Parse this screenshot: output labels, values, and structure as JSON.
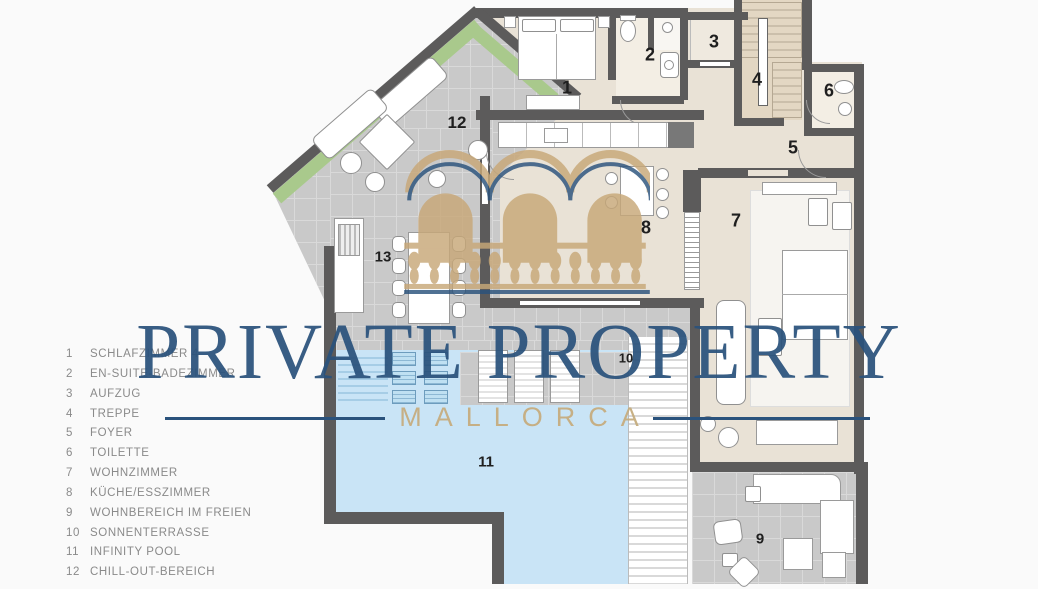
{
  "watermark": {
    "title": "PRIVATE PROPERTY",
    "subtitle": "MALLORCA"
  },
  "legend": {
    "items": [
      {
        "num": "1",
        "label": "SCHLAFZIMMER 4"
      },
      {
        "num": "2",
        "label": "EN-SUITE-BADEZIMMER"
      },
      {
        "num": "3",
        "label": "AUFZUG"
      },
      {
        "num": "4",
        "label": "TREPPE"
      },
      {
        "num": "5",
        "label": "FOYER"
      },
      {
        "num": "6",
        "label": "TOILETTE"
      },
      {
        "num": "7",
        "label": "WOHNZIMMER"
      },
      {
        "num": "8",
        "label": "KÜCHE/ESSZIMMER"
      },
      {
        "num": "9",
        "label": "WOHNBEREICH IM FREIEN"
      },
      {
        "num": "10",
        "label": "SONNENTERRASSE"
      },
      {
        "num": "11",
        "label": "INFINITY POOL"
      },
      {
        "num": "12",
        "label": "CHILL-OUT-BEREICH"
      }
    ]
  },
  "plan": {
    "room_numbers": [
      {
        "n": "1",
        "x": 567,
        "y": 88,
        "s": 18
      },
      {
        "n": "2",
        "x": 650,
        "y": 55,
        "s": 18
      },
      {
        "n": "3",
        "x": 714,
        "y": 42,
        "s": 18
      },
      {
        "n": "4",
        "x": 757,
        "y": 80,
        "s": 18
      },
      {
        "n": "5",
        "x": 793,
        "y": 148,
        "s": 18
      },
      {
        "n": "6",
        "x": 829,
        "y": 91,
        "s": 18
      },
      {
        "n": "7",
        "x": 736,
        "y": 221,
        "s": 18
      },
      {
        "n": "8",
        "x": 646,
        "y": 228,
        "s": 18
      },
      {
        "n": "9",
        "x": 760,
        "y": 539,
        "s": 15
      },
      {
        "n": "10",
        "x": 626,
        "y": 358,
        "s": 13
      },
      {
        "n": "11",
        "x": 486,
        "y": 462,
        "s": 15
      },
      {
        "n": "12",
        "x": 457,
        "y": 123,
        "s": 17
      },
      {
        "n": "13",
        "x": 383,
        "y": 257,
        "s": 15
      }
    ],
    "colors": {
      "wall": "#5c5b5b",
      "interior": "#e9e2d6",
      "interior_light": "#f3eee4",
      "terrace": "#c9c9c9",
      "grid": "#d9d9d9",
      "pool": "#c9e4f6",
      "hedge": "#a9c98c",
      "stairs": "#e3d7c3",
      "tread": "#cbbfab",
      "blue": "#2a527c",
      "gold": "#c6ad7f",
      "logo_tan": "#c8a878",
      "legend_text": "#8a8a8a",
      "number": "#1f1f1f"
    }
  }
}
